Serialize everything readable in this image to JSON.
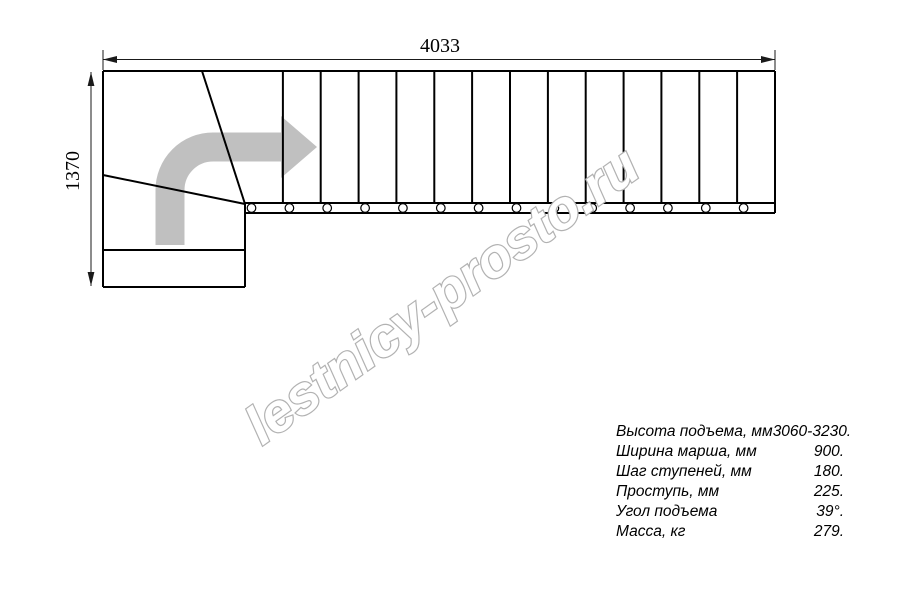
{
  "diagram": {
    "type": "staircase-floor-plan",
    "description": "L-shaped (quarter-turn) staircase top view with winder steps and direction arrow",
    "dimensions": {
      "width_mm": "4033",
      "height_mm": "1370"
    },
    "straight_tread_count": 14,
    "winder_divider_count": 2,
    "bolt_count": 14,
    "direction_arrow": "turn-right-then-straight"
  },
  "watermark": {
    "text": "lestnicy-prosto.ru"
  },
  "specs": {
    "rows": [
      {
        "label": "Высота подъема, мм",
        "value": "3060-3230."
      },
      {
        "label": "Ширина марша, мм",
        "value": "900."
      },
      {
        "label": "Шаг ступеней, мм",
        "value": "180."
      },
      {
        "label": "Проступь, мм",
        "value": "225."
      },
      {
        "label": "Угол подъема",
        "value": "39°."
      },
      {
        "label": "Масса, кг",
        "value": "279."
      }
    ]
  },
  "colors": {
    "line": "#000000",
    "dimension": "#1a1a1a",
    "direction_arrow_fill": "#c0c0c0",
    "watermark_outline": "#b2b2b2",
    "background": "#ffffff"
  }
}
